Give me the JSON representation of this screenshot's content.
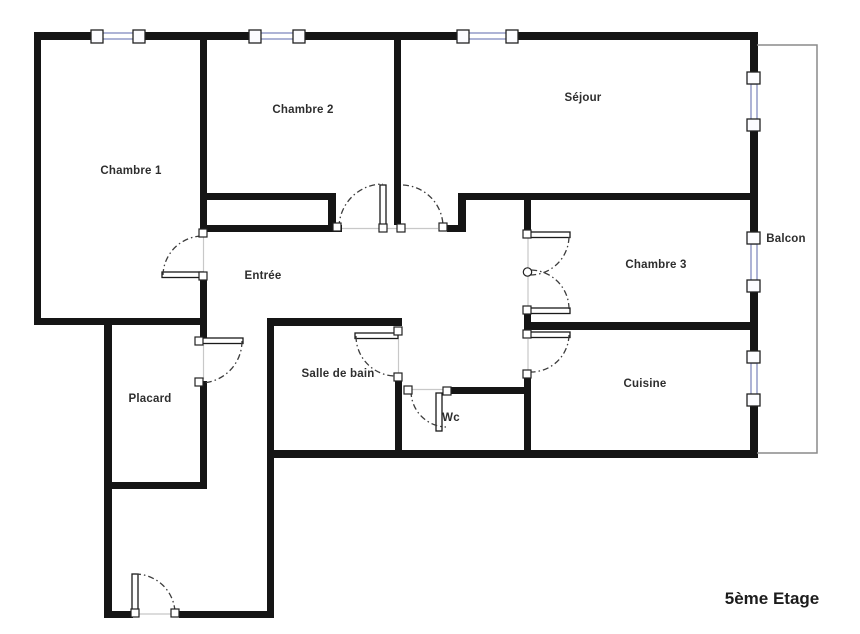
{
  "floor_plan": {
    "floor_label": "5ème Etage",
    "rooms": {
      "chambre1": "Chambre 1",
      "chambre2": "Chambre 2",
      "sejour": "Séjour",
      "balcon": "Balcon",
      "chambre3": "Chambre 3",
      "entree": "Entrée",
      "placard": "Placard",
      "salle_de_bain": "Salle de bain",
      "wc": "Wc",
      "cuisine": "Cuisine"
    },
    "colors": {
      "wall": "#151515",
      "window_frame": "#8c93c4",
      "balcony_outline": "#8a8a8a",
      "label_text": "#2e2e2e"
    }
  }
}
